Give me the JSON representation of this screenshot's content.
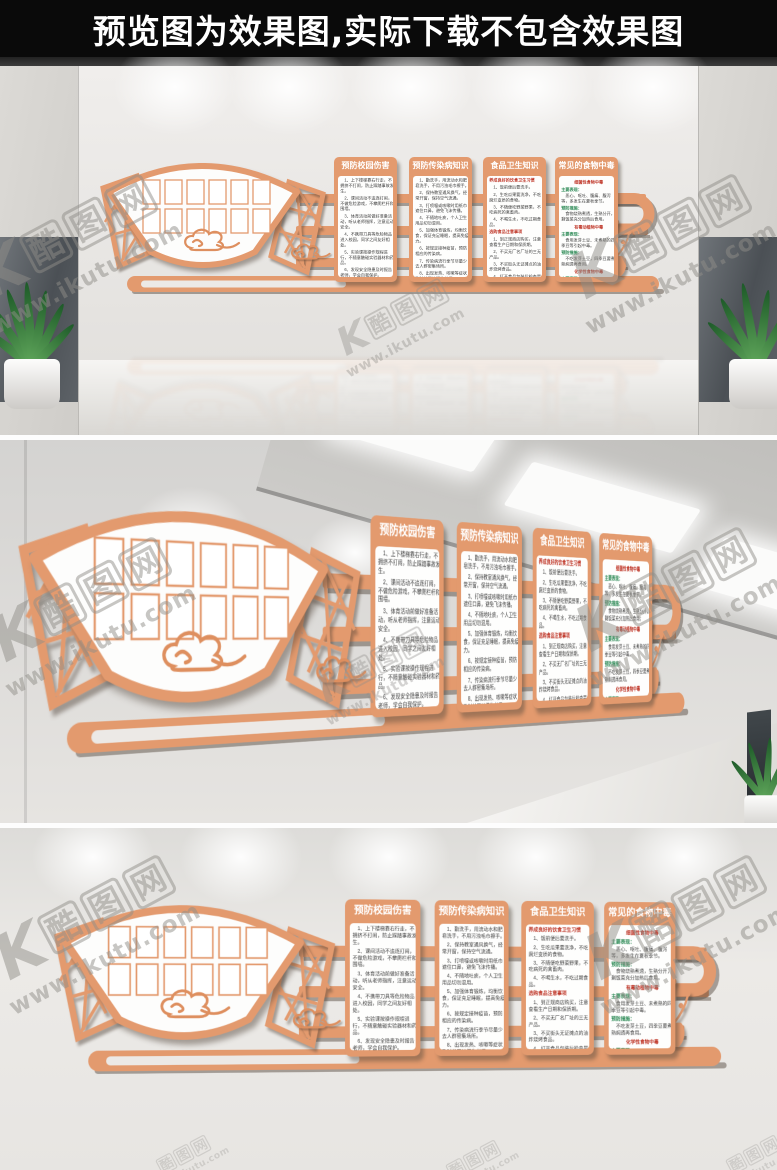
{
  "banner": {
    "text": "预览图为效果图,实际下载不包含效果图"
  },
  "watermark": {
    "logo_letter": "K",
    "site_name": "酷图网",
    "chars": [
      "酷",
      "图",
      "网"
    ],
    "url": "www.ikutu.com"
  },
  "colors": {
    "accent_orange": "#E39A6E",
    "banner_bg": "#0A0A0A",
    "banner_text": "#FFFFFF",
    "panel_text": "#3A3A3A",
    "highlight_red": "#C0392B",
    "highlight_green": "#2E8B57",
    "wall_grey": "#E8E6E3"
  },
  "wall": {
    "photo_grid": {
      "rows": 2,
      "cols": 6
    },
    "decorations": [
      "fan-shape",
      "lattice-left",
      "lattice-right",
      "cloud-motif",
      "small-cloud-motif",
      "scroll-bar",
      "rails",
      "hook-bracket",
      "flower-vase"
    ],
    "panels": [
      {
        "title": "预防校园伤害",
        "blocks": [
          {
            "style": "text",
            "text": "1、上下楼梯靠右行走，不拥挤不打闹，防止踩踏事故发生。"
          },
          {
            "style": "text",
            "text": "2、课间活动不追逐打闹，不做危险游戏，不攀爬栏杆和围墙。"
          },
          {
            "style": "text",
            "text": "3、体育活动前做好准备活动，听从老师指挥，注意运动安全。"
          },
          {
            "style": "text",
            "text": "4、不携带刀具等危险物品进入校园，同学之间友好相处。"
          },
          {
            "style": "text",
            "text": "5、实验课按操作规程进行，不随意触碰实验器材和药品。"
          },
          {
            "style": "text",
            "text": "6、发现安全隐患及时报告老师，学会自我保护。"
          },
          {
            "style": "text",
            "text": "7、放学后按时回家，不在校园内逗留打闹。"
          }
        ]
      },
      {
        "title": "预防传染病知识",
        "blocks": [
          {
            "style": "text",
            "text": "1、勤洗手，用流动水和肥皂洗手，不用污浊毛巾擦手。"
          },
          {
            "style": "text",
            "text": "2、保持教室通风换气，经常开窗，保持空气流通。"
          },
          {
            "style": "text",
            "text": "3、打喷嚏或咳嗽时用纸巾遮住口鼻，避免飞沫传播。"
          },
          {
            "style": "text",
            "text": "4、不随地吐痰，个人卫生用品切勿混用。"
          },
          {
            "style": "text",
            "text": "5、加强体育锻炼，均衡饮食，保证充足睡眠，提高免疫力。"
          },
          {
            "style": "text",
            "text": "6、按规定接种疫苗，预防相应的传染病。"
          },
          {
            "style": "text",
            "text": "7、传染病流行季节尽量少去人群密集场所。"
          },
          {
            "style": "text",
            "text": "8、出现发热、咳嗽等症状及时就医并报告老师。"
          }
        ]
      },
      {
        "title": "食品卫生知识",
        "blocks": [
          {
            "style": "red",
            "text": "养成良好的饮食卫生习惯"
          },
          {
            "style": "text",
            "text": "1、饭前便后要洗手。"
          },
          {
            "style": "text",
            "text": "2、生吃瓜果要洗净，不吃腐烂变质的食物。"
          },
          {
            "style": "text",
            "text": "3、不随便吃野菜野果，不吃病死的禽畜肉。"
          },
          {
            "style": "text",
            "text": "4、不喝生水，不吃过期食品。"
          },
          {
            "style": "red",
            "text": "选购食品注意事项"
          },
          {
            "style": "text",
            "text": "1、到正规商店购买，注意查看生产日期和保质期。"
          },
          {
            "style": "text",
            "text": "2、不买无厂名厂址的三无产品。"
          },
          {
            "style": "text",
            "text": "3、不买街头无证摊点的油炸烧烤食品。"
          },
          {
            "style": "text",
            "text": "4、打开食品包装后检查是否有异味变质。"
          }
        ]
      },
      {
        "title": "常见的食物中毒",
        "blocks": [
          {
            "style": "red-center",
            "text": "细菌性食物中毒"
          },
          {
            "style": "green",
            "text": "主要表现："
          },
          {
            "style": "text",
            "text": "恶心、呕吐、腹痛、腹泻等，多发生在夏秋季节。"
          },
          {
            "style": "green",
            "text": "预防措施："
          },
          {
            "style": "text",
            "text": "食物烧熟煮透，生熟分开，剩饭菜充分加热后食用。"
          },
          {
            "style": "red-center",
            "text": "有毒动植物中毒"
          },
          {
            "style": "green",
            "text": "主要表现："
          },
          {
            "style": "text",
            "text": "食用发芽土豆、未煮熟的四季豆等引起中毒。"
          },
          {
            "style": "green",
            "text": "预防措施："
          },
          {
            "style": "text",
            "text": "不吃发芽土豆，四季豆要煮熟焖透再食用。"
          },
          {
            "style": "red-center",
            "text": "化学性食物中毒"
          },
          {
            "style": "green",
            "text": "主要表现："
          },
          {
            "style": "text",
            "text": "误食被农药污染的食物引起，发病快症状重。"
          },
          {
            "style": "green",
            "text": "预防措施：蔬菜水果食用前充分浸泡清洗。"
          }
        ]
      }
    ]
  }
}
